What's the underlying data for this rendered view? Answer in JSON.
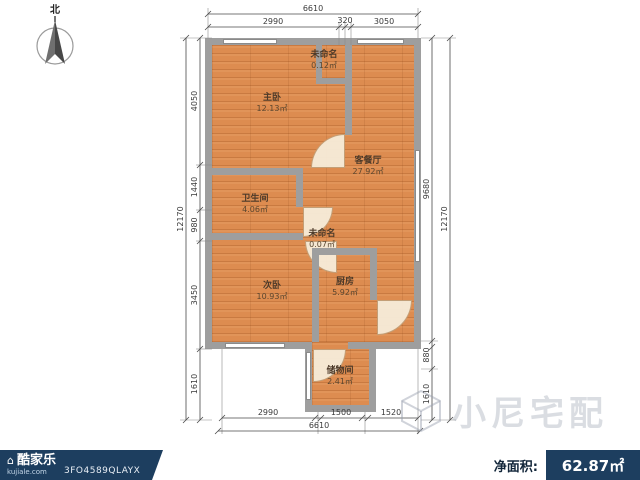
{
  "compass": {
    "label": "北"
  },
  "plan": {
    "rooms": [
      {
        "name": "未命名",
        "area": "0.12㎡"
      },
      {
        "name": "主卧",
        "area": "12.13㎡"
      },
      {
        "name": "客餐厅",
        "area": "27.92㎡"
      },
      {
        "name": "卫生间",
        "area": "4.06㎡"
      },
      {
        "name": "未命名",
        "area": "0.07㎡"
      },
      {
        "name": "次卧",
        "area": "10.93㎡"
      },
      {
        "name": "厨房",
        "area": "5.92㎡"
      },
      {
        "name": "储物间",
        "area": "2.41㎡"
      }
    ]
  },
  "dims": {
    "top": {
      "overall": "6610",
      "segments": [
        "2990",
        "320",
        "3050"
      ]
    },
    "bottom": {
      "overall": "6610",
      "segments": [
        "2990",
        "1500",
        "1520"
      ]
    },
    "left": {
      "overall": "12170",
      "segments": [
        "4050",
        "1440",
        "980",
        "3450",
        "1610"
      ]
    },
    "right": {
      "overall": "12170",
      "segments": [
        "9680",
        "880",
        "1610"
      ]
    }
  },
  "watermark": {
    "text": "小尼宅配"
  },
  "footer": {
    "brand": "酷家乐",
    "domain": "kujiale.com",
    "code": "3FO4589QLAYX",
    "net_area_label": "净面积:",
    "net_area_value": "62.87㎡"
  },
  "colors": {
    "accent": "#1d3e5f",
    "floor": "#dd8c50",
    "wall": "#9e9e9e"
  }
}
